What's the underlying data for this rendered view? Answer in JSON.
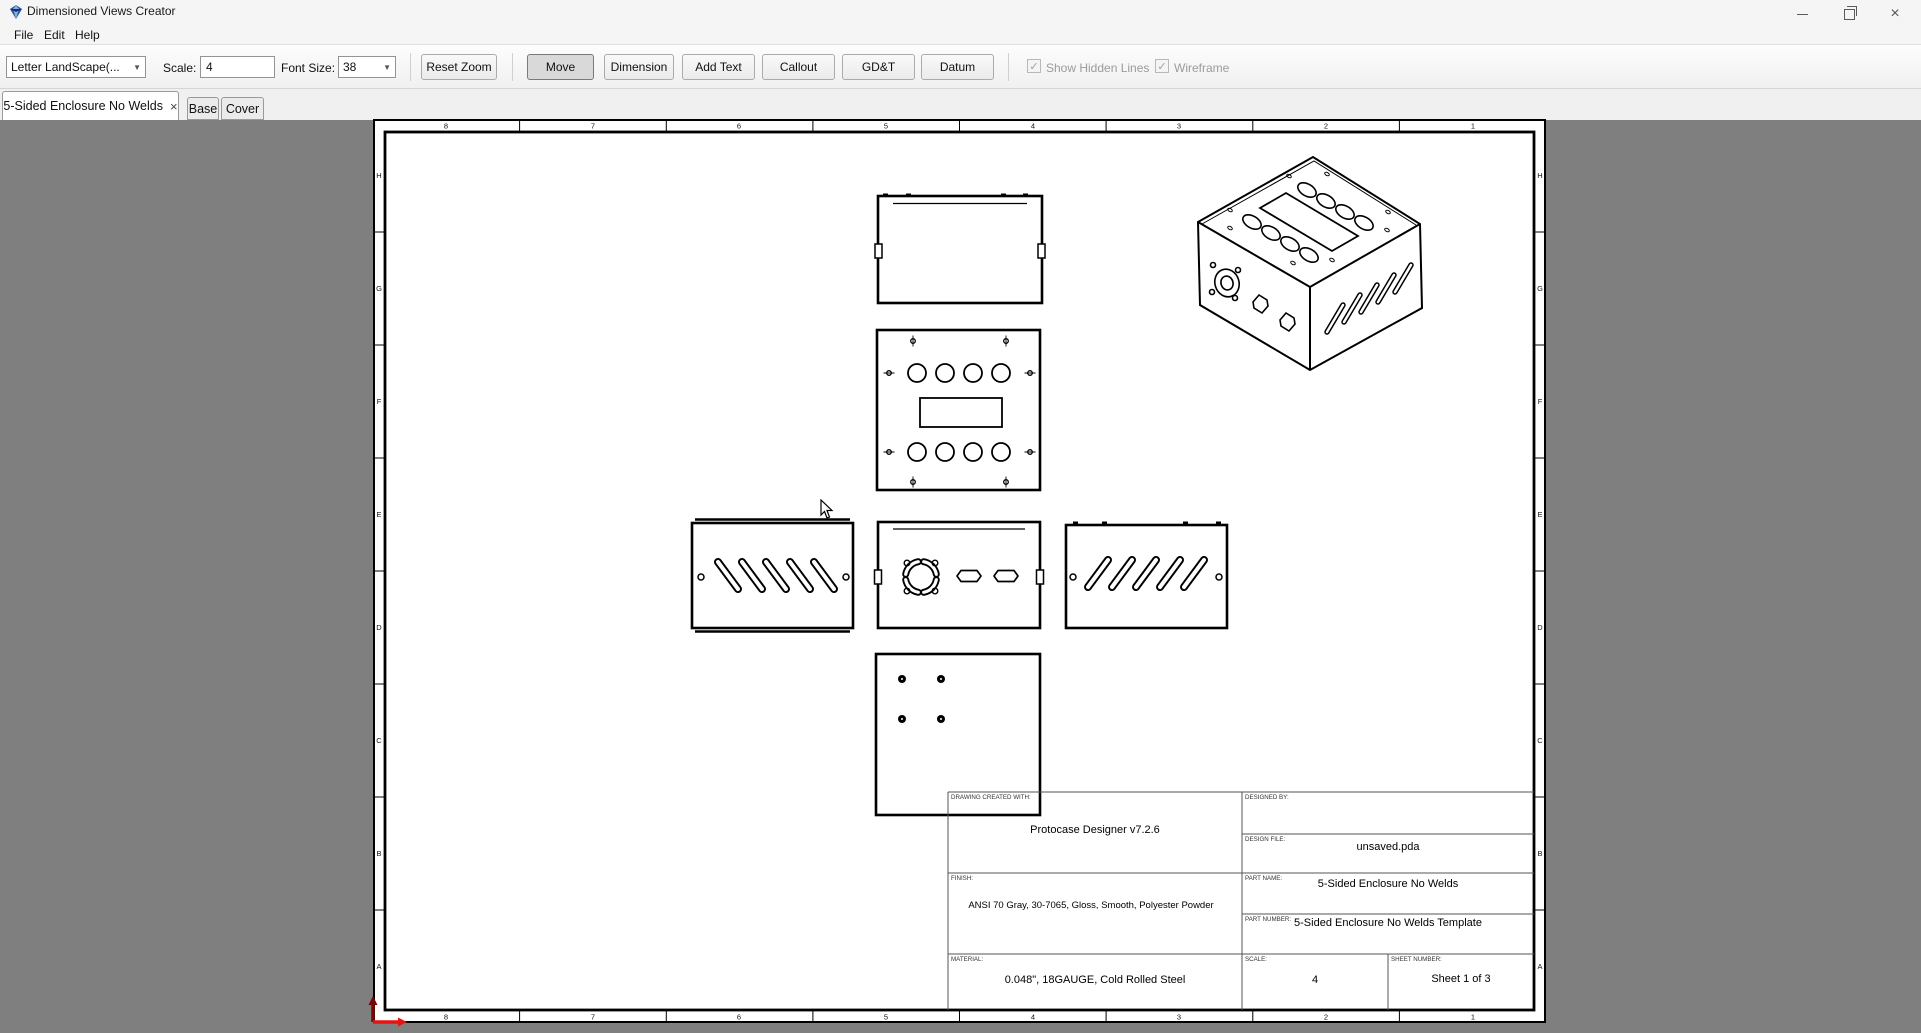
{
  "window": {
    "title": "Dimensioned Views Creator"
  },
  "menu": {
    "items": [
      "File",
      "Edit",
      "Help"
    ]
  },
  "toolbar": {
    "page_size_value": "Letter LandScape(...",
    "scale_label": "Scale:",
    "scale_value": "4",
    "font_size_label": "Font Size:",
    "font_size_value": "38",
    "reset_zoom": "Reset Zoom",
    "move": "Move",
    "dimension": "Dimension",
    "add_text": "Add Text",
    "callout": "Callout",
    "gdt": "GD&T",
    "datum": "Datum",
    "active_button": "Move",
    "show_hidden_lines": "Show Hidden Lines",
    "wireframe": "Wireframe",
    "show_hidden_lines_checked": true,
    "wireframe_checked": true
  },
  "icons": {
    "check": "✓",
    "tab_close": "×",
    "chevron": "▼"
  },
  "tabs": [
    {
      "label": "5-Sided Enclosure No Welds",
      "closable": true,
      "active": true
    },
    {
      "label": "Base"
    },
    {
      "label": "Cover"
    }
  ],
  "sheet": {
    "columns": [
      "8",
      "7",
      "6",
      "5",
      "4",
      "3",
      "2",
      "1"
    ],
    "rows": [
      "H",
      "G",
      "F",
      "E",
      "D",
      "C",
      "B",
      "A"
    ]
  },
  "titleblock": {
    "labels": {
      "created_with": "DRAWING CREATED WITH:",
      "designed_by": "DESIGNED BY:",
      "design_file": "DESIGN FILE:",
      "finish": "FINISH:",
      "part_name": "PART NAME:",
      "part_number": "PART NUMBER:",
      "material": "MATERIAL:",
      "scale": "SCALE:",
      "sheet_number": "SHEET NUMBER:"
    },
    "values": {
      "created_with": "Protocase Designer v7.2.6",
      "design_file": "unsaved.pda",
      "finish": "ANSI 70 Gray, 30-7065, Gloss, Smooth, Polyester Powder",
      "part_name": "5-Sided Enclosure No Welds",
      "part_number": "5-Sided Enclosure No Welds Template",
      "material": "0.048\", 18GAUGE, Cold Rolled Steel",
      "scale": "4",
      "sheet_number": "Sheet 1 of 3"
    }
  },
  "colors": {
    "canvas_gray": "#7f7f7f",
    "origin_x_arrow": "#e81212",
    "origin_y_arrow": "#7a0404",
    "line_black": "#000000"
  }
}
